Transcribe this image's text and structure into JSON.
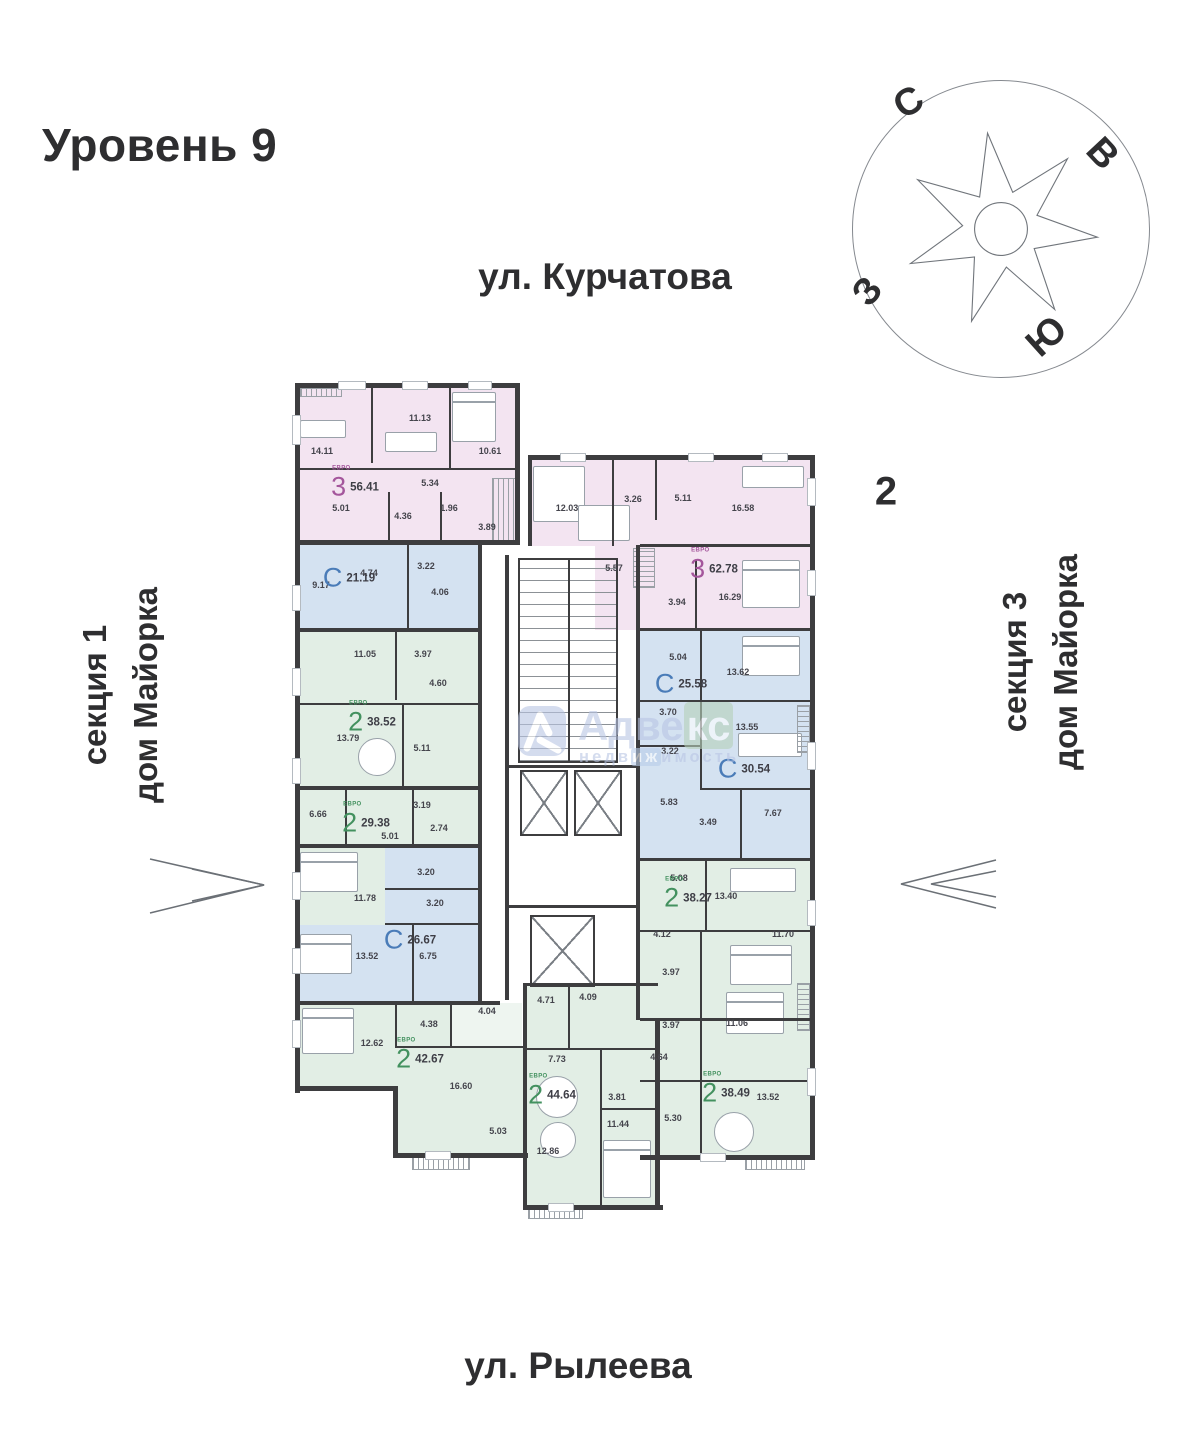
{
  "header": {
    "title": "Уровень 9"
  },
  "building_number": "2",
  "streets": {
    "top": "ул. Курчатова",
    "bottom": "ул. Рылеева"
  },
  "side_labels": {
    "left": {
      "line1": "секция 1",
      "line2": "дом Майорка"
    },
    "right": {
      "line1": "секция 3",
      "line2": "дом Майорка"
    }
  },
  "compass": {
    "north": "С",
    "east": "В",
    "west": "З",
    "south": "Ю"
  },
  "watermark": {
    "brand_part1": "Адве",
    "brand_part2": "кс",
    "sub_part1": "недв",
    "sub_part2": "иж",
    "sub_part3": "имость"
  },
  "palette": {
    "rooms_3euro": "#f3e4f1",
    "rooms_studio": "#d4e2f1",
    "rooms_2euro": "#e2eee5",
    "wall": "#3d3d3f",
    "label_3euro": "#a4569c",
    "label_studio": "#4a7cb8",
    "label_2euro": "#43915f"
  },
  "apartments": [
    {
      "type": "3",
      "tag": "евро",
      "area": "56.41",
      "rooms": [
        "14.11",
        "11.13",
        "10.61",
        "5.01",
        "5.34",
        "4.36",
        "1.96",
        "3.89"
      ]
    },
    {
      "type": "С",
      "area": "21.19",
      "rooms": [
        "9.17",
        "4.74",
        "3.22",
        "4.06"
      ]
    },
    {
      "type": "2",
      "tag": "евро",
      "area": "38.52",
      "rooms": [
        "11.05",
        "3.97",
        "4.60",
        "13.79",
        "5.11"
      ]
    },
    {
      "type": "2",
      "tag": "евро",
      "area": "29.38",
      "rooms": [
        "6.66",
        "3.19",
        "5.01",
        "2.74",
        "11.78"
      ]
    },
    {
      "type": "С",
      "area": "26.67",
      "rooms": [
        "3.20",
        "3.20",
        "13.52",
        "6.75"
      ]
    },
    {
      "type": "2",
      "tag": "евро",
      "area": "42.67",
      "rooms": [
        "12.62",
        "4.38",
        "4.04",
        "16.60",
        "5.03"
      ]
    },
    {
      "type": "2",
      "tag": "евро",
      "area": "44.64",
      "rooms": [
        "4.71",
        "4.09",
        "7.73",
        "12.86",
        "3.81",
        "11.44"
      ]
    },
    {
      "type": "3",
      "tag": "евро",
      "area": "62.78",
      "rooms": [
        "12.03",
        "3.26",
        "5.11",
        "16.58",
        "5.57",
        "3.94",
        "16.29"
      ]
    },
    {
      "type": "С",
      "area": "25.58",
      "rooms": [
        "5.04",
        "13.62",
        "3.70",
        "3.22"
      ]
    },
    {
      "type": "С",
      "area": "30.54",
      "rooms": [
        "13.55",
        "5.83",
        "3.49",
        "7.67"
      ]
    },
    {
      "type": "2",
      "tag": "евро",
      "area": "38.27",
      "rooms": [
        "5.08",
        "13.40",
        "4.12",
        "11.70",
        "3.97"
      ]
    },
    {
      "type": "2",
      "tag": "евро",
      "area": "38.49",
      "rooms": [
        "3.97",
        "11.06",
        "4.64",
        "5.30",
        "13.52"
      ]
    }
  ]
}
